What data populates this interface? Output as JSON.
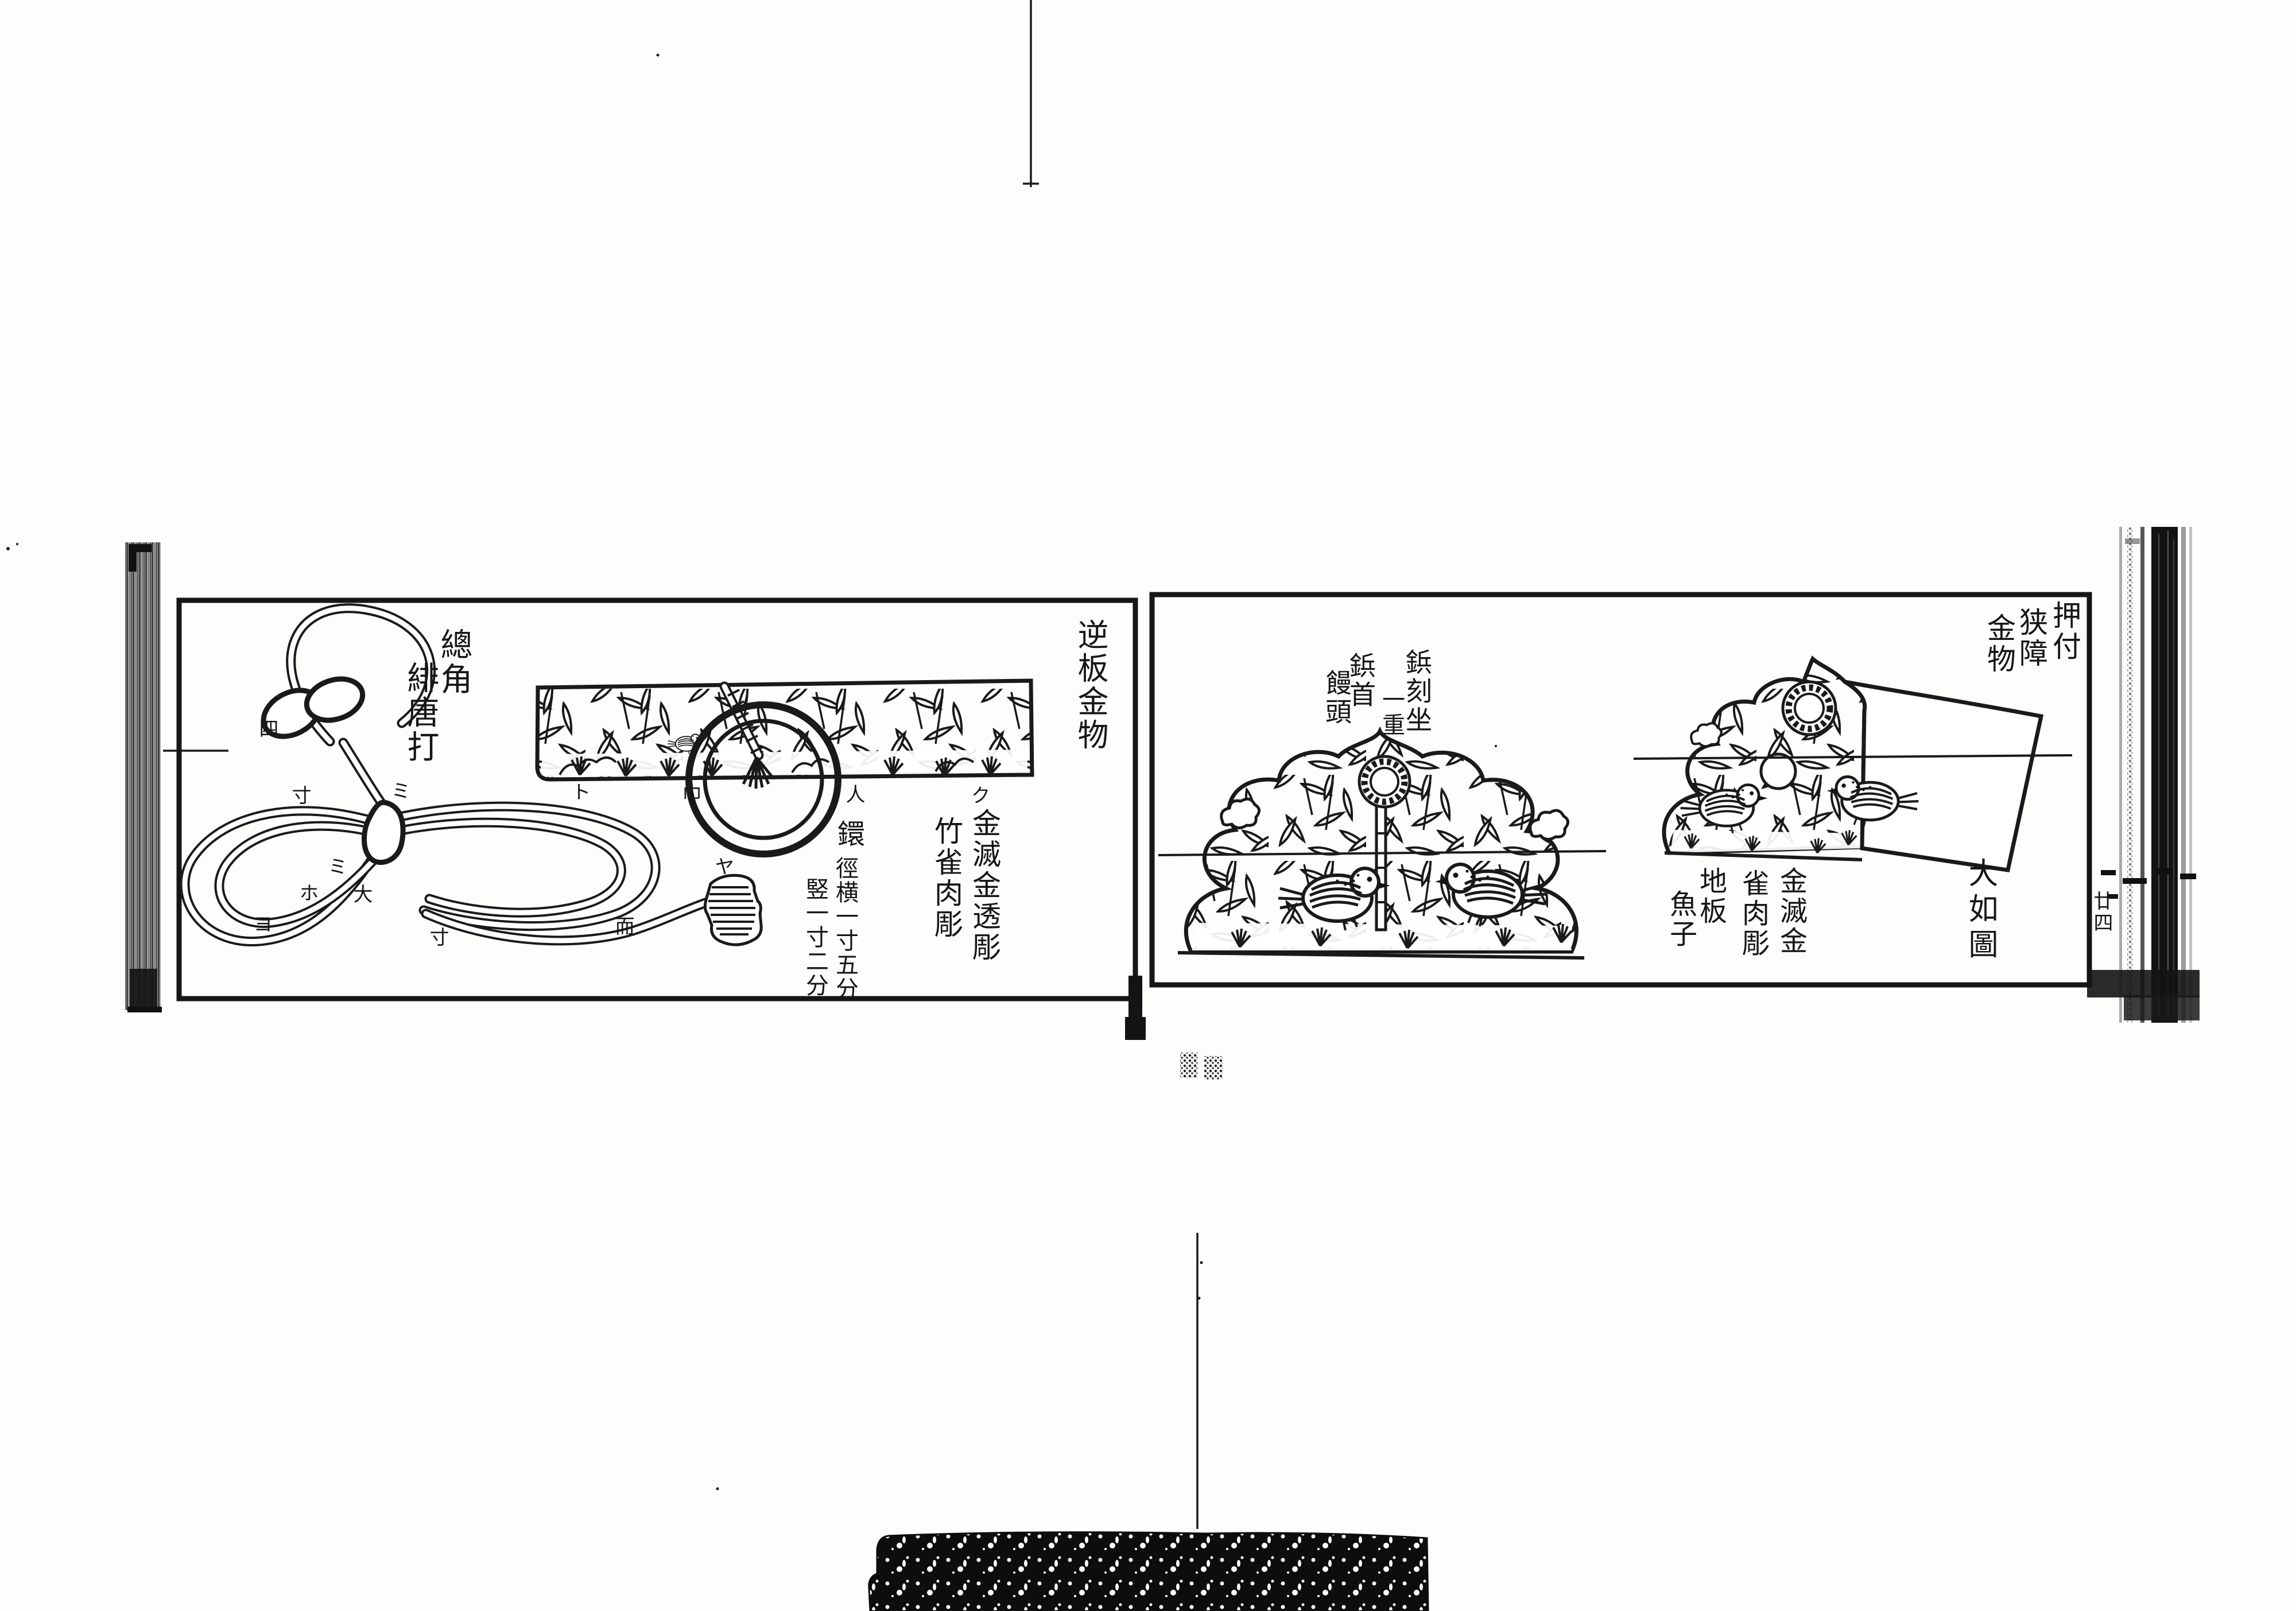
{
  "document": {
    "kind_note": "Edo-period woodblock book scan, two facing panels of metal-fitting designs",
    "ink_color": "#1a1a1a",
    "paper_color": "#fdfdfc"
  },
  "left_page": {
    "title_columns": [
      "總角",
      "緋唐打"
    ],
    "side_title": "逆板金物",
    "spec_columns": [
      "金滅金透彫",
      "竹雀肉彫"
    ],
    "ring_spec": {
      "head": "鐶",
      "dim_main": "徑横一寸五分",
      "dim_sub": "竪一寸二分"
    },
    "knot_marks": [
      "四",
      "寸",
      "ミ",
      "ミ",
      "ホ",
      "大",
      "ヨ",
      "寸",
      "而",
      "ヤ"
    ],
    "band_marks": [
      "ト",
      "巾",
      "人",
      "ク"
    ]
  },
  "right_page": {
    "title_columns": [
      "押付",
      "狭障",
      "金物"
    ],
    "rivet_columns": [
      "鋲刻坐",
      "一重",
      "鋲首",
      "饅頭"
    ],
    "finish_columns": [
      "金滅金",
      "雀肉彫",
      "地板",
      "魚子"
    ],
    "size_note": "大如圖",
    "page_number": "廿四"
  }
}
